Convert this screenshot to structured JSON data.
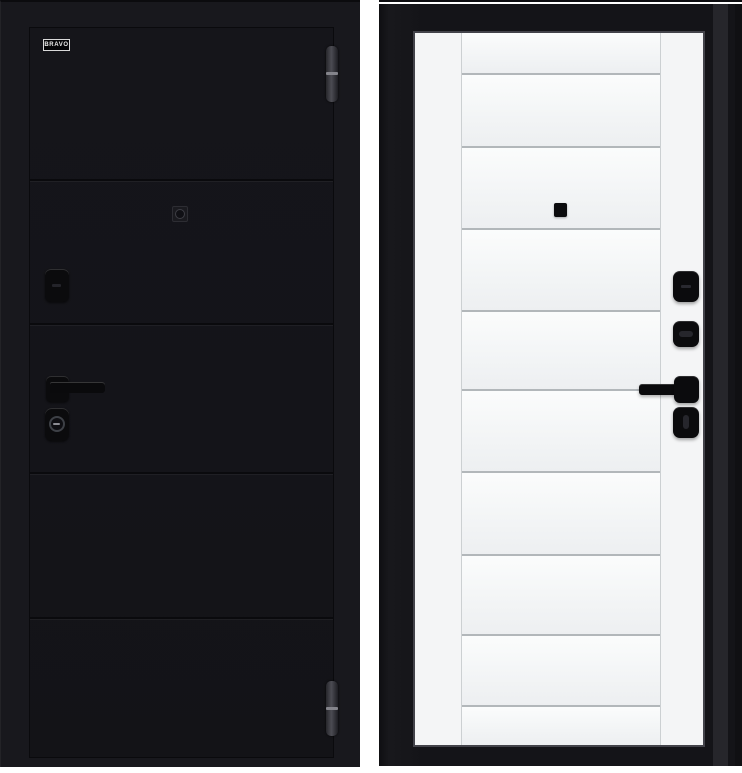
{
  "page": {
    "background": "#ffffff"
  },
  "brand": {
    "logo_text": "BRAVO"
  },
  "exterior_door": {
    "view": "exterior-black-side",
    "leaf_color": "#141419",
    "frame_color": "#18181d",
    "groove_ys": [
      151,
      295,
      444,
      589
    ],
    "hardware": {
      "color": "#0b0b0d",
      "items": [
        "brand-logo",
        "peephole",
        "keyhole-escutcheon",
        "lever-handle",
        "cylinder-lock",
        "hinge-top",
        "hinge-bottom"
      ]
    }
  },
  "interior_door": {
    "view": "interior-white-side",
    "leaf_color": "#f4f5f6",
    "frame_color": "#141418",
    "groove_ys": [
      40,
      113,
      195,
      277,
      356,
      438,
      521,
      601,
      672
    ],
    "field_height": 712,
    "panel_top_color": "#fbfcfc",
    "panel_bottom_color": "#edeff1",
    "hardware": {
      "color": "#0b0b0d",
      "items": [
        "peephole",
        "night-latch-cover",
        "thumbturn",
        "lever-handle",
        "lock-knob"
      ]
    }
  }
}
